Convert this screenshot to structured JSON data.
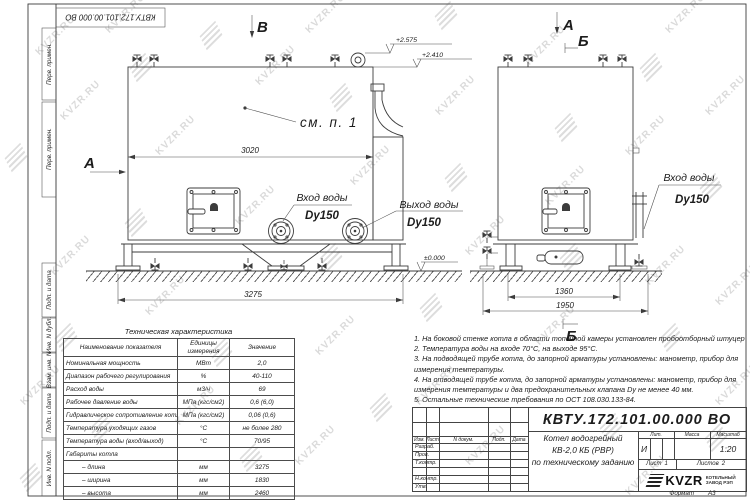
{
  "frame": {
    "doc_number_top": "КВТУ.172.101.00.000 ВО",
    "stamps": [
      "Перв. примен.",
      "Перв. примен.",
      "Подп. и дата",
      "Инв. N дубл.",
      "Взам. инв. N",
      "Подп. и дата",
      "Инв. N подл."
    ]
  },
  "drawing": {
    "labels": {
      "view_b": "В",
      "view_a_left": "А",
      "view_a_right": "А",
      "sec_b_top": "Б",
      "sec_b_bottom": "Б",
      "callout": "см. п. 1"
    },
    "elevations": {
      "top": "+2.575",
      "mid": "+2.410",
      "zero": "±0.000"
    },
    "dims": {
      "left_inner": "3020",
      "left_outer": "3275",
      "right_inner": "1360",
      "right_outer": "1950"
    },
    "ports": {
      "inlet_left": {
        "name": "Вход воды",
        "size": "Dy150"
      },
      "outlet_left": {
        "name": "Выход воды",
        "size": "Dy150"
      },
      "inlet_right": {
        "name": "Вход воды",
        "size": "Dy150"
      }
    }
  },
  "spec_table": {
    "title": "Техническая характеристика",
    "headers": [
      "Наименование показателя",
      "Единицы измерения",
      "Значение"
    ],
    "rows": [
      [
        "Номинальная мощность",
        "МВт",
        "2,0"
      ],
      [
        "Диапазон рабочего регулирования",
        "%",
        "40-110"
      ],
      [
        "Расход воды",
        "м3/ч",
        "69"
      ],
      [
        "Рабочее давление воды",
        "МПа (кгс/см2)",
        "0,6 (6,0)"
      ],
      [
        "Гидравлическое сопротивление котла",
        "МПа (кгс/см2)",
        "0,06 (0,6)"
      ],
      [
        "Температура уходящих газов",
        "°С",
        "не более 280"
      ],
      [
        "Температура воды (вход/выход)",
        "°С",
        "70/95"
      ],
      [
        "Габариты котла",
        "",
        ""
      ],
      [
        "– длина",
        "мм",
        "3275"
      ],
      [
        "– ширина",
        "мм",
        "1830"
      ],
      [
        "– высота",
        "мм",
        "2460"
      ]
    ]
  },
  "notes": [
    "1. На боковой стенке котла в области топочной камеры установлен пробоотборный штуцер",
    "2. Температура воды на входе 70°С, на выходе 95°С.",
    "3. На подводящей трубе котла, до запорной арматуры установлены: манометр, прибор для измерения температуры.",
    "4. На отводящей трубе котла, до запорной арматуры установлены: манометр, прибор для измерения температуры и два предохранительных клапана Dу не менее 40 мм.",
    "5. Остальные технические требования по ОСТ 108.030.133-84."
  ],
  "title_block": {
    "doc_number": "КВТУ.172.101.00.000 ВО",
    "rev_headers": [
      "Изм.",
      "Лист",
      "N докум.",
      "Подп.",
      "Дата"
    ],
    "sig_rows": [
      "Разраб.",
      "Пров.",
      "Т.контр.",
      "",
      "Н.контр.",
      "Утв."
    ],
    "name_lines": [
      "Котел водогрейный",
      "КВ-2,0 КБ (РВР)",
      "по техническому заданию"
    ],
    "lit_header": "Лит.",
    "mass_header": "Масса",
    "scale_header": "Масштаб",
    "lit_value": "И",
    "scale_value": "1:20",
    "sheet_label": "Лист",
    "sheet_value": "1",
    "sheets_label": "Листов",
    "sheets_value": "2",
    "logo_text": "KVZR",
    "company_lines": [
      "КОТЕЛЬНЫЙ",
      "ЗАВОД РЭП"
    ],
    "format_label": "Формат",
    "format_value": "А3"
  },
  "watermark": {
    "text": "KVZR.RU"
  }
}
